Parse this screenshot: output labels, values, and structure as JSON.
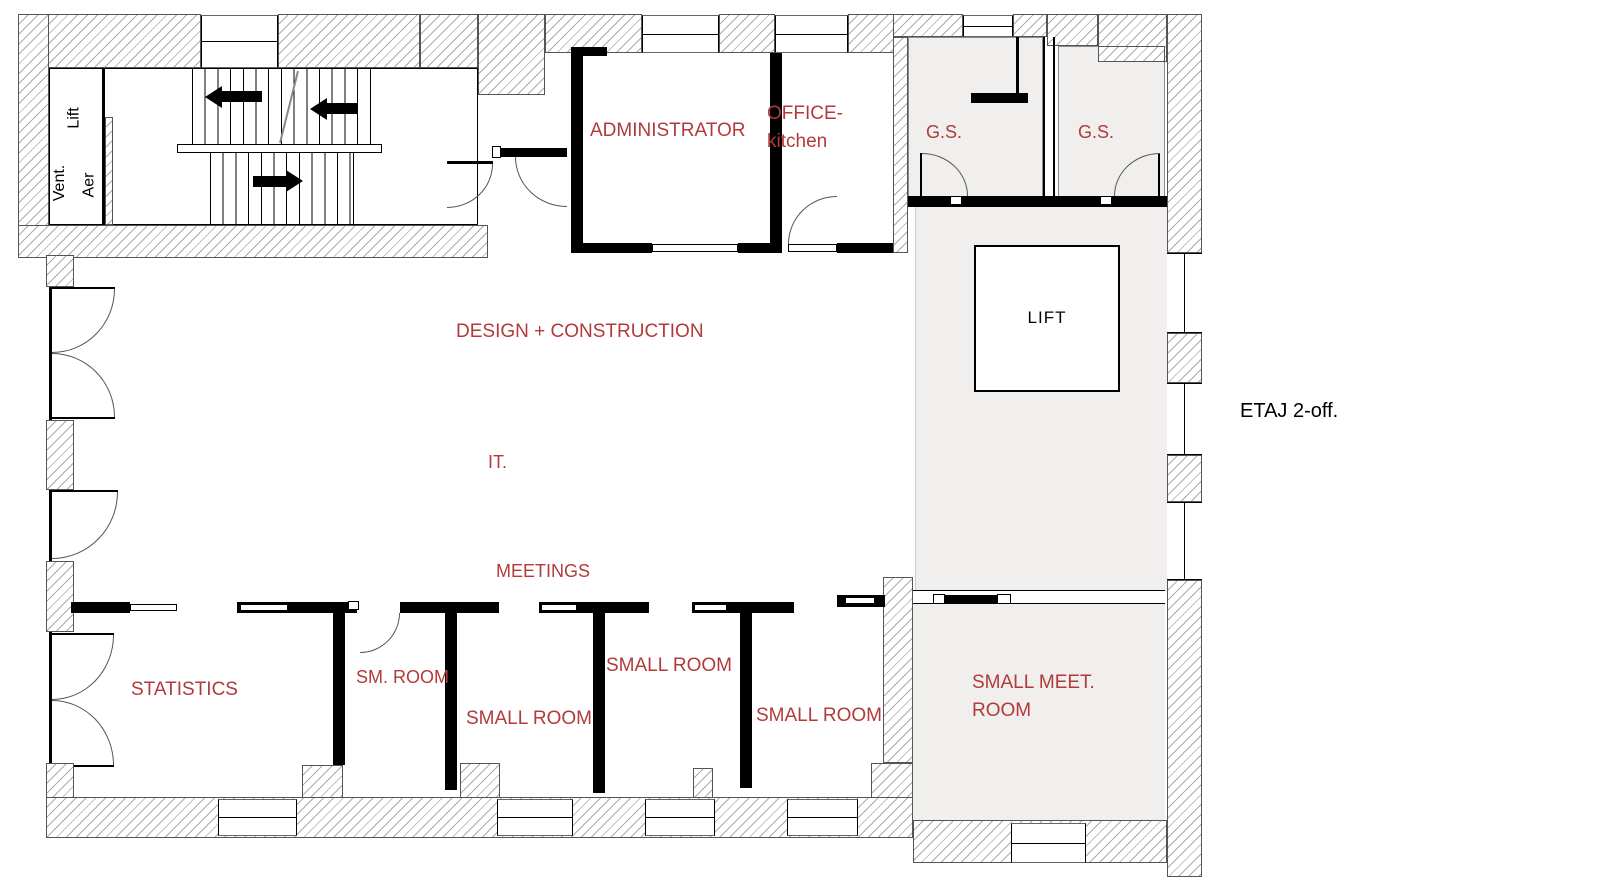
{
  "title": "Office floor plan",
  "floor_label": "ETAJ 2-off.",
  "colors": {
    "label_red": "#b23a3a",
    "ink": "#000000",
    "hatch_line": "#ababab",
    "room_fill": "#f0efed"
  },
  "labels": {
    "lift_shaft": "Lift",
    "vent": "Vent.",
    "aer": "Aer",
    "administrator": "ADMINISTRATOR",
    "office_line1": "OFFICE-",
    "office_line2": "kitchen",
    "gs_left": "G.S.",
    "gs_right": "G.S.",
    "lift_cab": "LIFT",
    "design_construction": "DESIGN + CONSTRUCTION",
    "it": "IT.",
    "meetings": "MEETINGS",
    "statistics": "STATISTICS",
    "sm_room": "SM. ROOM",
    "small_room_a": "SMALL ROOM",
    "small_room_b": "SMALL ROOM",
    "small_room_c": "SMALL ROOM",
    "small_meet_line1": "SMALL MEET.",
    "small_meet_line2": "ROOM",
    "floor": "ETAJ 2-off."
  },
  "icons": {
    "stair_arrow_1": "arrow-left",
    "stair_arrow_2": "arrow-left",
    "stair_arrow_3": "arrow-right"
  }
}
